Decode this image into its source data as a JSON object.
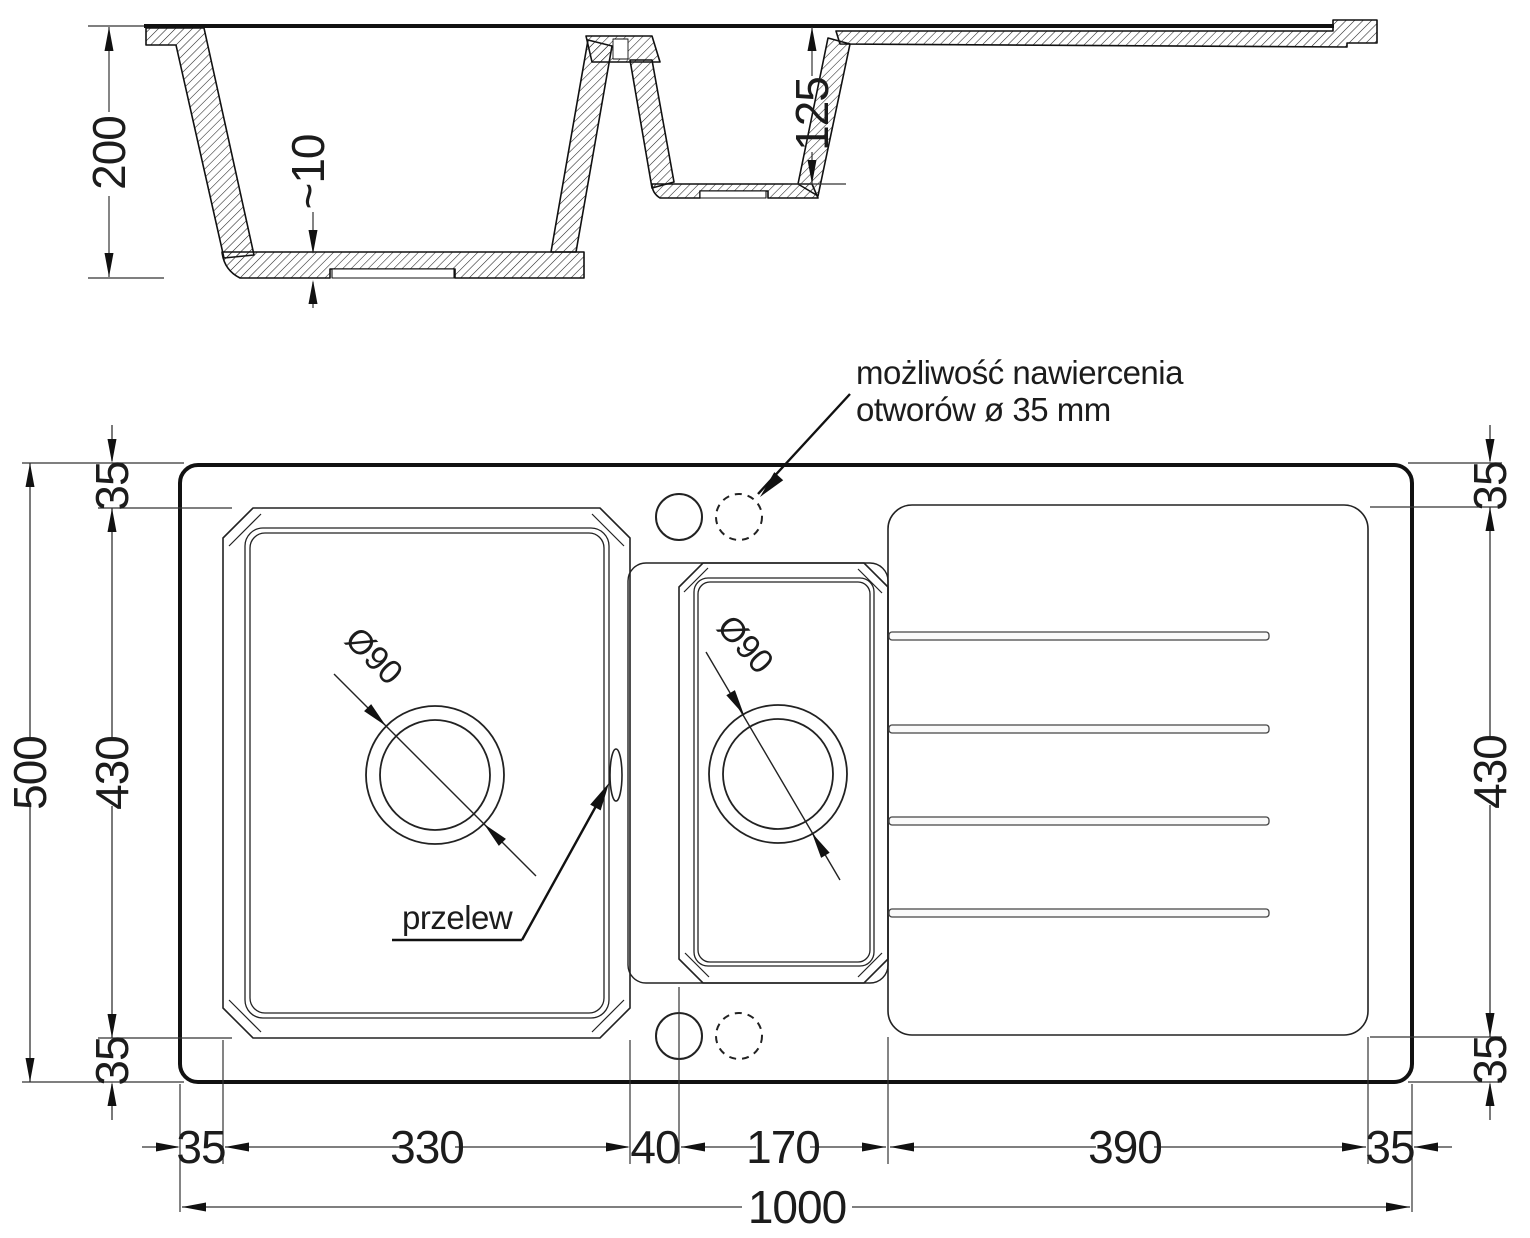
{
  "section_view": {
    "overall_depth": "200",
    "base_thickness": "~10",
    "half_bowl_depth": "125"
  },
  "plan_view": {
    "drill_note_line1": "możliwość nawiercenia",
    "drill_note_line2": "otworów ø 35 mm",
    "overflow_label": "przelew",
    "main_drain_diameter": "Ø90",
    "half_drain_diameter": "Ø90",
    "dims_left": {
      "total_height": "500",
      "top_margin": "35",
      "bowl_height": "430",
      "bottom_margin": "35"
    },
    "dims_right": {
      "top_margin": "35",
      "drainer_height": "430",
      "bottom_margin": "35"
    },
    "dims_bottom": {
      "left_margin": "35",
      "main_bowl_width": "330",
      "divider_width": "40",
      "half_bowl_width": "170",
      "drainer_width": "390",
      "right_margin": "35",
      "total_width": "1000"
    }
  },
  "line_color": "#111111"
}
